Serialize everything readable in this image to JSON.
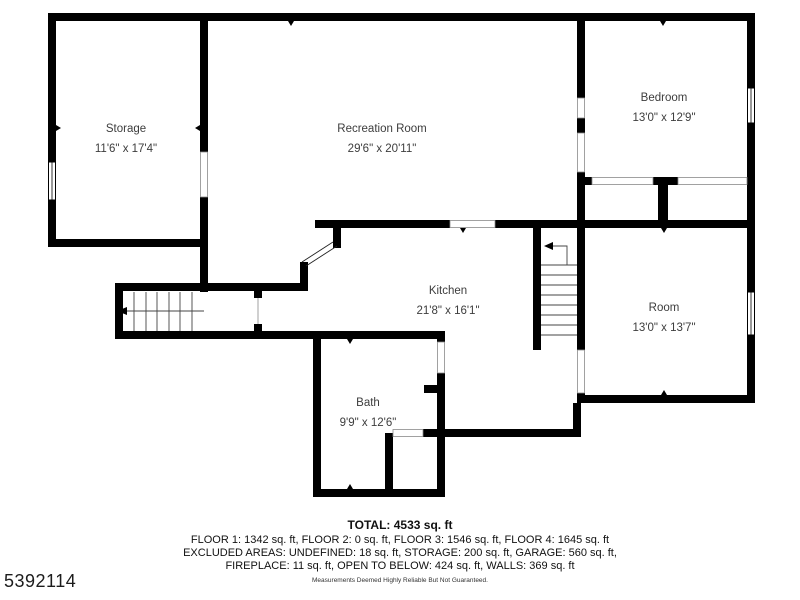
{
  "floorplan": {
    "rooms": [
      {
        "name": "Storage",
        "dims": "11'6\" x 17'4\""
      },
      {
        "name": "Recreation Room",
        "dims": "29'6\" x 20'11\""
      },
      {
        "name": "Bedroom",
        "dims": "13'0\" x 12'9\""
      },
      {
        "name": "Kitchen",
        "dims": "21'8\" x 16'1\""
      },
      {
        "name": "Room",
        "dims": "13'0\" x 13'7\""
      },
      {
        "name": "Bath",
        "dims": "9'9\" x 12'6\""
      }
    ],
    "colors": {
      "wall": "#000000",
      "background": "#ffffff",
      "label_text": "#3d3d3d"
    }
  },
  "footer": {
    "total": "TOTAL: 4533 sq. ft",
    "line1": "FLOOR 1: 1342 sq. ft, FLOOR 2: 0 sq. ft, FLOOR 3: 1546 sq. ft, FLOOR 4: 1645 sq. ft",
    "line2": "EXCLUDED AREAS: UNDEFINED: 18 sq. ft, STORAGE: 200 sq. ft, GARAGE: 560 sq. ft,",
    "line3": "FIREPLACE: 11 sq. ft, OPEN TO BELOW: 424 sq. ft, WALLS: 369 sq. ft",
    "disclaimer": "Measurements Deemed Highly Reliable But Not Guaranteed."
  },
  "watermark": {
    "id": "5392114"
  }
}
